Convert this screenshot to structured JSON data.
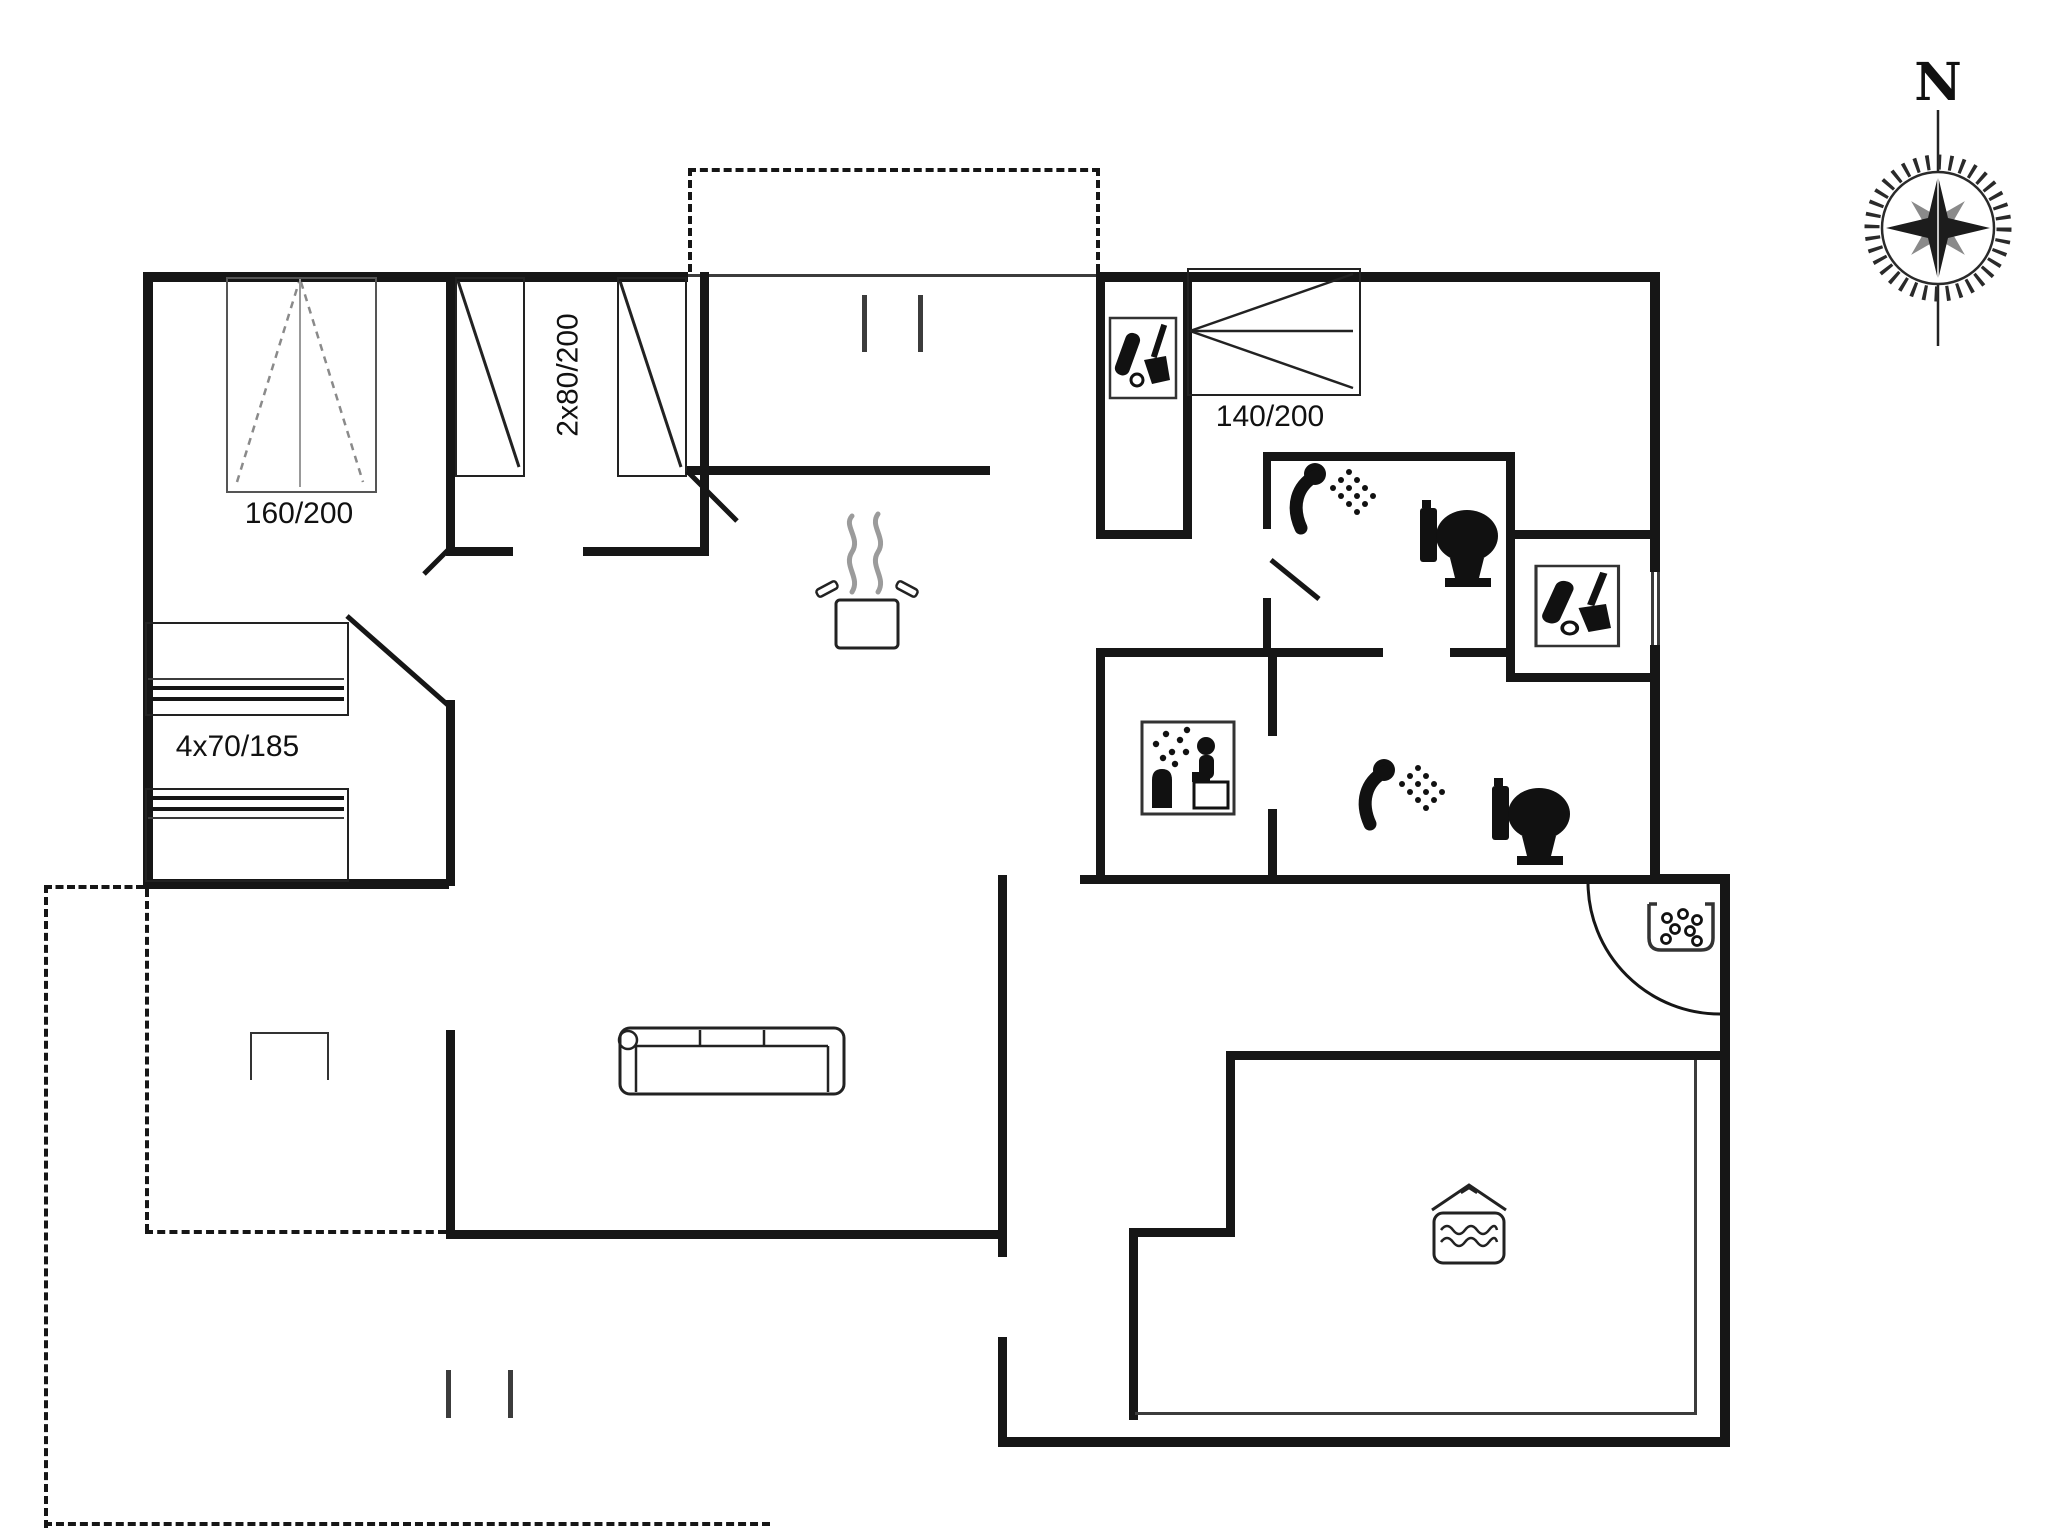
{
  "floorplan": {
    "title": "holiday-home floor plan",
    "labels": {
      "double_bed": "160/200",
      "twin_beds": "2x80/200",
      "bed_140": "140/200",
      "bunk_beds": "4x70/185",
      "compass_north": "N"
    },
    "rooms": [
      "bedroom-double",
      "bedroom-twin",
      "bedroom-140",
      "bunk-area",
      "hall",
      "corridor",
      "bathroom-1",
      "bathroom-2",
      "sauna",
      "utility-closet-1",
      "utility-closet-2",
      "kitchen",
      "living-room",
      "entrance",
      "hot-tub-room",
      "terrace-top",
      "terrace-bottom"
    ],
    "icons": [
      "shower-icon",
      "toilet-icon",
      "sauna-icon",
      "cleaning-cupboard-icon",
      "sink-icon",
      "hot-tub-icon",
      "stove-pot-icon",
      "sofa-icon",
      "table-icon",
      "compass-rose-icon",
      "door-swing-arc"
    ],
    "colors": {
      "background": "#ffffff",
      "wall": "#161616",
      "thin_line": "#3c3c3c",
      "bed_dash": "#8a8a8a",
      "steam": "#9b9b9b"
    }
  }
}
